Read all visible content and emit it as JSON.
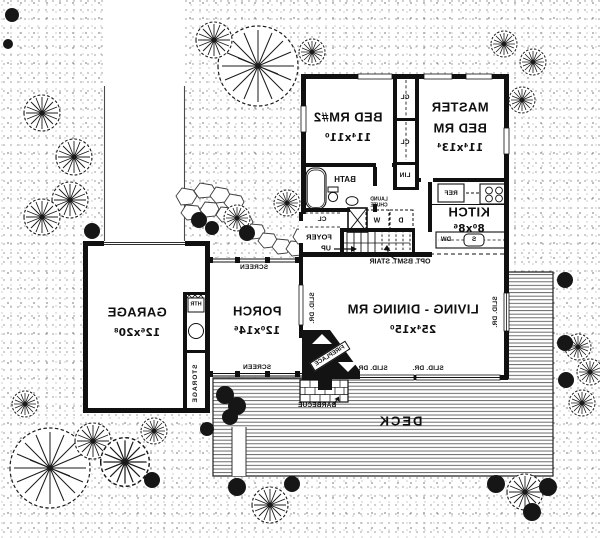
{
  "plan_title": "Mirrored first floor plan",
  "colors": {
    "ink": "#101010",
    "paper": "#ffffff"
  },
  "rooms": {
    "living": {
      "name": "LIVING - DINING RM",
      "dims": "25⁴x15⁰"
    },
    "master": {
      "name_line1": "MASTER",
      "name_line2": "BED RM",
      "dims": "11⁴x13⁴"
    },
    "bed2": {
      "name": "BED RM#2",
      "dims": "11⁴x11⁰"
    },
    "kitchen": {
      "name": "KITCH",
      "dims": "8⁰x8⁶"
    },
    "garage": {
      "name": "GARAGE",
      "dims": "12⁶x20⁸"
    },
    "porch": {
      "name": "PORCH",
      "dims": "12⁰x14⁶"
    },
    "deck": {
      "name": "DECK"
    },
    "bath": {
      "name": "BATH"
    },
    "foyer": {
      "name": "FOYER"
    },
    "storage": {
      "name": "STORAGE"
    }
  },
  "fixtures": {
    "closet_upper": "CL",
    "closet_lower": "CL",
    "linen": "LIN",
    "foyer_closet": "CL",
    "washer": "W",
    "dryer": "D",
    "laundry_chute_line1": "LAUND",
    "laundry_chute_line2": "CHUTE",
    "refrigerator": "REF",
    "dishwasher": "DW",
    "sink": "S",
    "heater": "HTR",
    "up": "UP",
    "opt_bsmt_stair": "OPT. BSMT. STAIR",
    "fireplace": "FIREPLACE",
    "barbecue": "BARBECUE"
  },
  "annotations": {
    "screen_top": "SCREEN",
    "screen_bottom": "SCREEN",
    "slid_dr_bottom_left": "SLID. DR.",
    "slid_dr_bottom_right": "SLID. DR.",
    "slid_dr_living_right": "SLID. DR.",
    "slid_dr_porch": "SLID. DR."
  }
}
